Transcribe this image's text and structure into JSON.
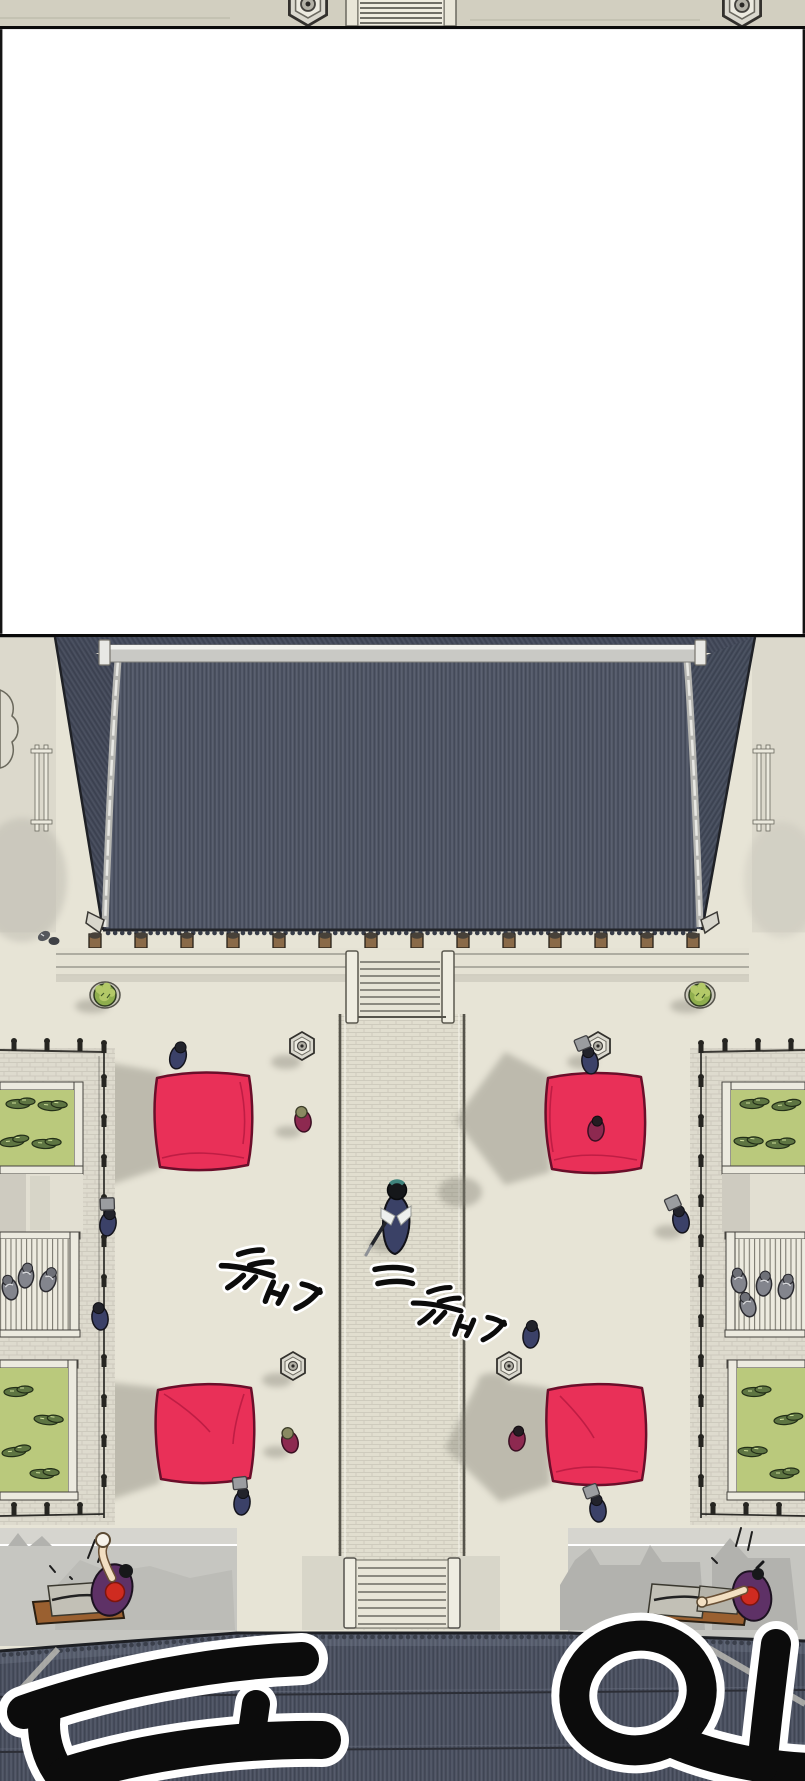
{
  "page": {
    "title": "Webtoon episode page — aerial view of a sect courtyard",
    "background": "#ffffff",
    "width_px": 805,
    "height_px": 1781,
    "panel_count": 2
  },
  "panels": {
    "top_sliver": {
      "description": "Bottom sliver of the previous panel: pale pavement with two stone lantern bases and a small stair block",
      "height_px": 29
    },
    "gutter": {
      "description": "White gutter between panels with thin black side borders",
      "height_px": 605
    },
    "main": {
      "description": "Top-down view of a courtyard: great tiled hall roof, central stone path with staircases, four red cloth mats, stone lanterns, fenced garden plots with lawns, many small figures, and a lower hall roof",
      "height_px": 1147
    }
  },
  "sfx": [
    {
      "id": "footstep-1",
      "text": "뚜벅",
      "romanization": "ttubeok",
      "meaning": "footstep thud",
      "style": "small black brush script with white outline, rotated clockwise",
      "location": "courtyard, left of the central path"
    },
    {
      "id": "footstep-2",
      "text": "뚜벅",
      "romanization": "ttubeok",
      "meaning": "footstep thud",
      "style": "small black brush script with white outline, rotated clockwise",
      "location": "courtyard, right of the central path, slightly lower"
    },
    {
      "id": "boom",
      "text": "두웅!",
      "romanization": "duung!",
      "meaning": "deep resounding boom",
      "style": "huge black brush strokes with thick white outline, clipped by the bottom edge",
      "location": "across the lower hall roof"
    }
  ],
  "scene": {
    "upper_hall": {
      "roof_color": "#505666",
      "ridge_color": "#c9c9c5",
      "pillar_count": 14,
      "pillar_color": "#8a6a48"
    },
    "courtyard": {
      "ground_color": "#e7e4d6",
      "central_path": {
        "left_x": 338,
        "width_px": 128,
        "paving": "stone bricks"
      },
      "red_mats": {
        "count": 4,
        "color": "#e93058"
      },
      "stone_lanterns": {
        "count": 4,
        "color": "#dad8ce"
      },
      "potted_shrubs": {
        "count": 2,
        "color": "#8fae4e"
      },
      "staircases": 2
    },
    "gardens": {
      "sides": 2,
      "lawn_color": "#bac97c",
      "shrub_color": "#5e7542",
      "fence_color": "#262521",
      "deck_slats": true
    },
    "figures": {
      "walking_swordsman": {
        "count": 1,
        "robe": "#3a4166",
        "headband": "#3f837c",
        "position": "on central path"
      },
      "navy_disciples": {
        "count": 8,
        "color": "#3b4168"
      },
      "gray_disciples": {
        "count": 7,
        "color": "#83858d"
      },
      "magenta_visitors": {
        "count": 4,
        "color": "#8d2950"
      },
      "desk_workers": {
        "count": 2,
        "robe": "#5e3166",
        "emblem": "#cf2b20"
      }
    },
    "lower_hall": {
      "roof_color": "#4d5363",
      "wall_color": "#c6c6c1",
      "desks": 2
    }
  },
  "palette": {
    "ink": "#0c0c0c",
    "outline_white": "#ffffff",
    "roof_stripe_dark": "#434958",
    "roof_stripe_light": "#5e6475",
    "shadow": "#8b897e",
    "paving": "#dedbce"
  }
}
